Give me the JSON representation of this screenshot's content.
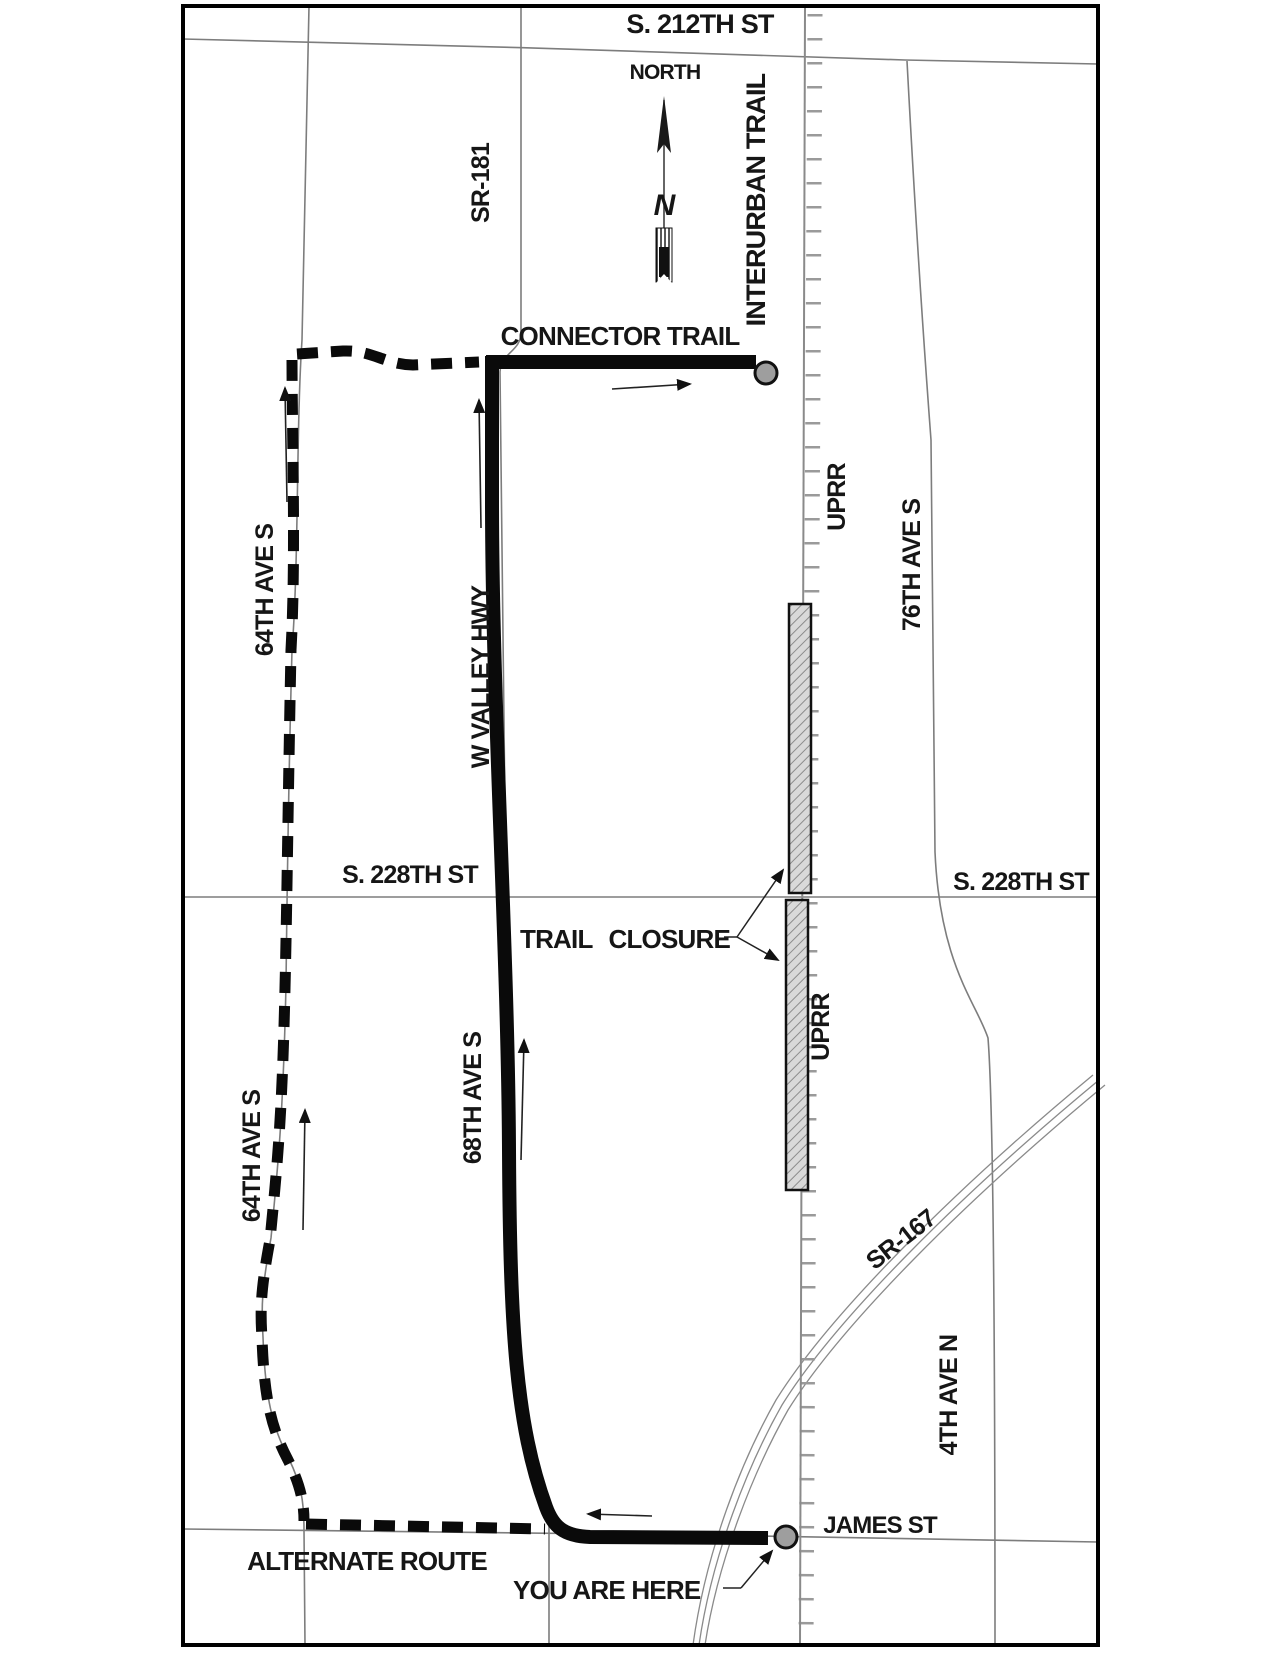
{
  "map": {
    "streets": {
      "s_212th": "S. 212TH ST",
      "s_228th": "S. 228TH ST",
      "james_st": "JAMES ST",
      "sr_181": "SR-181",
      "sr_167": "SR-167",
      "w_valley_hwy": "W VALLEY HWY",
      "ave_64th": "64TH AVE S",
      "ave_68th": "68TH AVE S",
      "ave_76th": "76TH AVE S",
      "ave_4th": "4TH AVE N",
      "uprr": "UPRR"
    },
    "annotations": {
      "north": "NORTH",
      "north_glyph": "N",
      "interurban_trail": "INTERURBAN TRAIL",
      "connector_trail": "CONNECTOR TRAIL",
      "trail_closure": "TRAIL CLOSURE",
      "alternate_route": "ALTERNATE ROUTE",
      "you_are_here": "YOU ARE HERE"
    },
    "colors": {
      "background": "#ffffff",
      "frame": "#000000",
      "road": "#7d7d7d",
      "railroad": "#8a8a8a",
      "route": "#0a0a0a",
      "closure_fill": "#d9d9d9",
      "closure_hatch": "#8c8c8c",
      "marker_fill": "#9e9e9e",
      "label_text": "#161616"
    }
  }
}
